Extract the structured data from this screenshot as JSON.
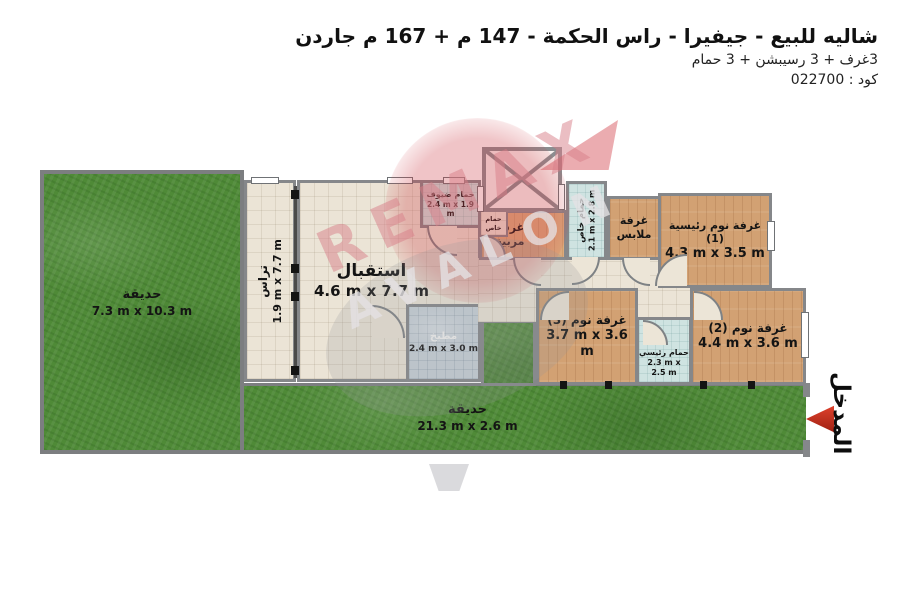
{
  "header": {
    "title": "شاليه للبيع - جيفيرا - راس الحكمة - 147 م + 167 م جاردن",
    "subtitle": "3غرف + 3 رسيبشن + 3 حمام",
    "code": "كود : 022700"
  },
  "watermark": {
    "line1": "REMAX",
    "line2": "AVALON"
  },
  "plan": {
    "garden_left": {
      "label": "حديقة",
      "dims": "7.3 m x 10.3 m"
    },
    "garden_bottom": {
      "label": "حديقة",
      "dims": "21.3 m x 2.6 m"
    },
    "terrace": {
      "label": "تراس",
      "dims": "1.9 m x 7.7 m"
    },
    "reception": {
      "label": "استقبال",
      "dims": "4.6 m x 7.7 m"
    },
    "kitchen": {
      "label": "مطبخ",
      "dims": "2.4 m x 3.0 m"
    },
    "guest_bath": {
      "label": "حمام ضيوف",
      "dims": "2.4 m x 1.9 m"
    },
    "small_bath": {
      "label": "حمام",
      "label2": "خاص"
    },
    "nanny": {
      "label": "غرفة",
      "label2": "مربية"
    },
    "private_bath": {
      "label": "حمام خاص",
      "dims": "2.1 m x 2.8 m"
    },
    "dressing": {
      "label": "غرفة",
      "label2": "ملابس"
    },
    "master": {
      "label": "غرفة نوم رئيسية (1)",
      "dims": "4.3 m x 3.5 m"
    },
    "bed2": {
      "label": "غرفة نوم (2)",
      "dims": "4.4 m x 3.6 m"
    },
    "bed3": {
      "label": "غرفة نوم (3)",
      "dims": "3.7 m x 3.6 m"
    },
    "main_bath": {
      "label": "حمام رئيسي",
      "dims": "2.3 m x 2.5 m"
    },
    "entrance": {
      "label": "المدخل"
    }
  },
  "colors": {
    "grass": "#4f8a37",
    "tile_floor": "#ebe4d6",
    "wood_floor": "#d2a173",
    "bath_floor": "#cfe3e1",
    "kitchen_floor": "#c7d1d8",
    "wall": "#85878a",
    "entrance_arrow": "#c2301d",
    "watermark_red": "#d87d87"
  }
}
